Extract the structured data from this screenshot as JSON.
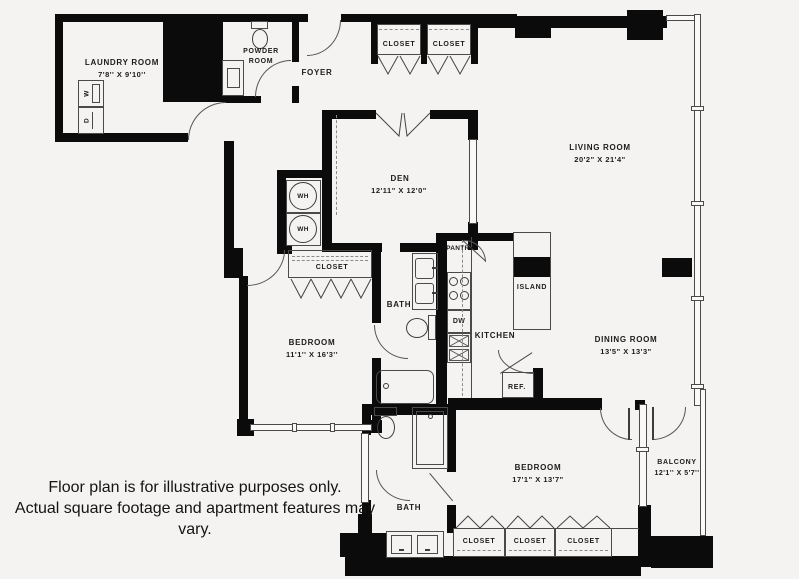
{
  "labels": {
    "laundry_name": "LAUNDRY ROOM",
    "laundry_dims": "7'8'' X 9'10''",
    "powder_line1": "POWDER",
    "powder_line2": "ROOM",
    "foyer": "FOYER",
    "closet": "CLOSET",
    "den_name": "DEN",
    "den_dims": "12'11\" X 12'0\"",
    "living_name": "LIVING ROOM",
    "living_dims": "20'2\" X 21'4\"",
    "bedroom1_name": "BEDROOM",
    "bedroom1_dims": "11'1'' X 16'3''",
    "bath": "BATH",
    "pantry": "PANTRY",
    "kitchen": "KITCHEN",
    "island": "ISLAND",
    "ref": "REF.",
    "dining_name": "DINING ROOM",
    "dining_dims": "13'5\" X 13'3\"",
    "bedroom2_name": "BEDROOM",
    "bedroom2_dims": "17'1\" X 13'7\"",
    "balcony_name": "BALCONY",
    "balcony_dims": "12'1'' X 5'7''"
  },
  "fixtures": {
    "washer": "W",
    "dryer": "D",
    "water_heater": "WH",
    "dishwasher": "DW"
  },
  "disclaimer": {
    "line1": "Floor plan is for illustrative purposes only.",
    "line2": "Actual square footage and apartment features may vary."
  },
  "colors": {
    "wall": "#0b0b0b",
    "line": "#4a4a4a",
    "paper": "#f4f3f1"
  }
}
